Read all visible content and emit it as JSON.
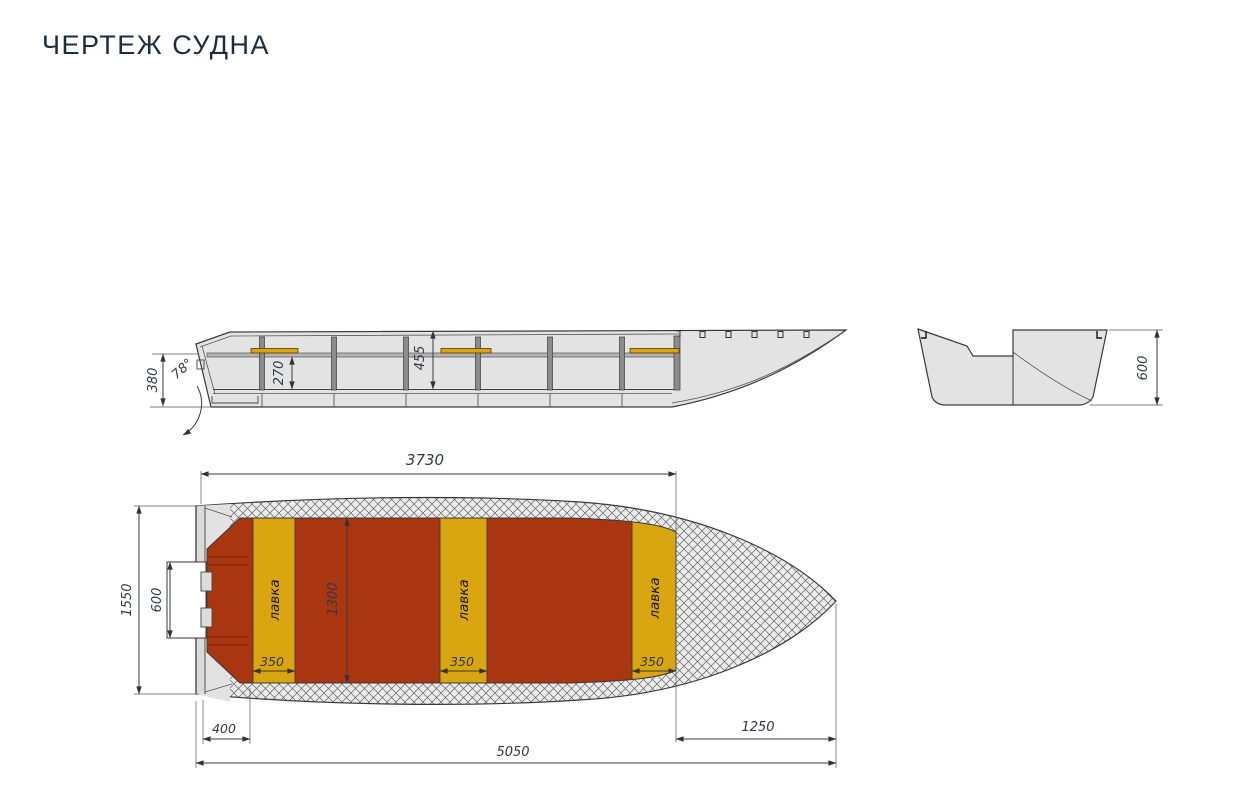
{
  "title": "ЧЕРТЕЖ СУДНА",
  "colors": {
    "title_text": "#1C2B45",
    "floor_red": "#A93511",
    "bench_yellow": "#D9A511",
    "hull_gray": "#E3E3E3",
    "hatch_bg": "#ECECEC",
    "line_dark": "#333333"
  },
  "side_view": {
    "transom_height": "380",
    "transom_angle": "78°",
    "bench_height": "270",
    "depth": "455"
  },
  "section_view": {
    "height": "600"
  },
  "top_view": {
    "cockpit_length": "3730",
    "beam": "1550",
    "motor_notch_width": "600",
    "floor_width": "1300",
    "bench_width": "350",
    "bench_label": "лавка",
    "stern_section": "400",
    "bow_section": "1250",
    "overall_length": "5050"
  }
}
